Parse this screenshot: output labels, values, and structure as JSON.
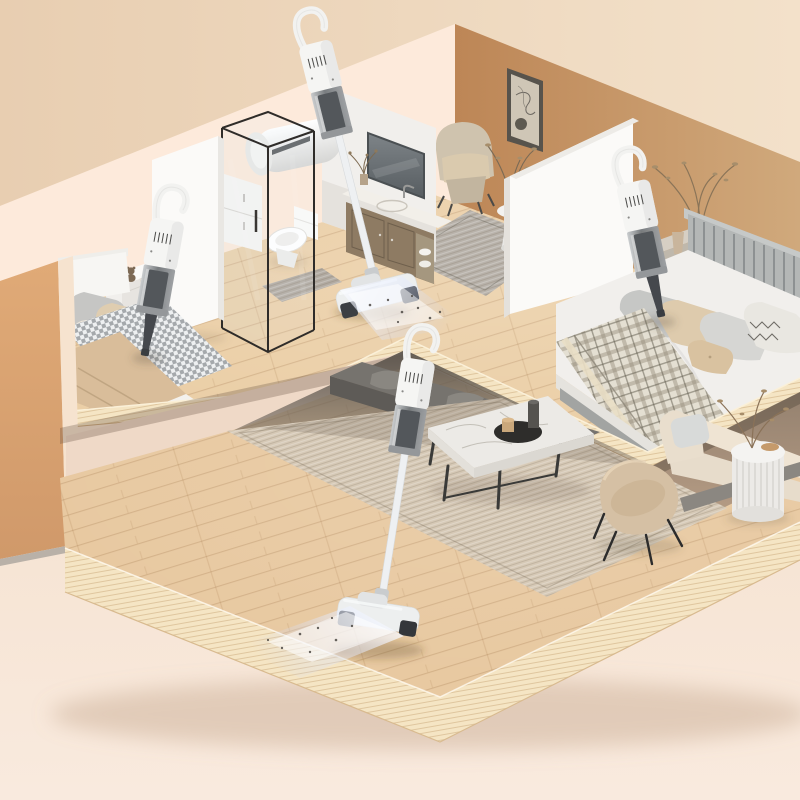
{
  "meta": {
    "domain": "product-render",
    "description": "Isometric cutaway render of a two-level apartment in warm beige tones showing four cordless vacuum cleaners cleaning different rooms",
    "visible_text": "none"
  },
  "colors": {
    "backdrop_top": "#ecd2b5",
    "backdrop_bottom": "#f8e9dc",
    "wall_cream": "#fdeadb",
    "wall_terracotta": "#c08a5a",
    "wall_tan": "#d9a471",
    "partition_white": "#fbfaf8",
    "floor_upper": "#ebcfa7",
    "floor_lower": "#e8c9a1",
    "slab_side": "#f5e5c4",
    "rug_nook": "#b8b2aa",
    "rug_living": "#d6c9b6",
    "bench_gray": "#76736e",
    "sofa_cream": "#e7dccb",
    "armchair_tan": "#d5c0a4",
    "table_marble": "#eceae6",
    "headboard_gray": "#b4b7b6",
    "bed_left_duvet": "#eef0f1",
    "bed_right_duvet": "#f1efec",
    "blanket_tan": "#d9bd9a",
    "vacuum_body": "#f4f4f2",
    "vacuum_cup": "#7e8285",
    "vacuum_dark": "#45484d",
    "glow": "#dce8ff",
    "underside_shadow": "#55504a"
  },
  "scene": {
    "levels": [
      {
        "name": "upper level",
        "rooms": [
          "left bedroom",
          "bathroom",
          "sitting nook",
          "right bedroom"
        ]
      },
      {
        "name": "lower level",
        "rooms": [
          "living room"
        ]
      }
    ],
    "rooms": [
      {
        "name": "left bedroom",
        "items": [
          "double bed with houndstooth duvet and tan throw",
          "white nightstand with teddy bear and book",
          "handheld cordless vacuum hovering over bed"
        ]
      },
      {
        "name": "bathroom",
        "items": [
          "glass shower enclosure",
          "toilet",
          "wall-mounted water heater",
          "gooseneck shower fixture",
          "white storage cabinet",
          "vanity with marble top and sink",
          "wall mirror",
          "bath mat"
        ]
      },
      {
        "name": "sitting nook",
        "items": [
          "terracotta accent wall",
          "abstract line-art poster",
          "beige armchair",
          "round pedestal side table with vase",
          "patterned gray rug",
          "dried branches"
        ]
      },
      {
        "name": "right bedroom",
        "items": [
          "double bed with slatted gray headboard",
          "plaid blanket",
          "assorted pillows",
          "nightstand with vase",
          "dried branch arrangement",
          "handheld cordless vacuum hovering over bed"
        ]
      },
      {
        "name": "living room",
        "items": [
          "large woven area rug",
          "marble coffee table with recessed tray and vases",
          "dark gray bench sofa",
          "cream sofa with cushion",
          "tan curved armchair",
          "white fluted side table with dried plant",
          "stick vacuum cleaning the floor"
        ]
      }
    ],
    "products": [
      {
        "name": "cordless handheld vacuum",
        "location": "left bedroom, above bed"
      },
      {
        "name": "cordless stick vacuum",
        "location": "standing on upper floor by the bathroom, light beam with dust particles"
      },
      {
        "name": "cordless handheld vacuum",
        "location": "right bedroom, above bed"
      },
      {
        "name": "cordless stick vacuum",
        "location": "lower living-room floor, light beam with dust particles"
      }
    ]
  }
}
